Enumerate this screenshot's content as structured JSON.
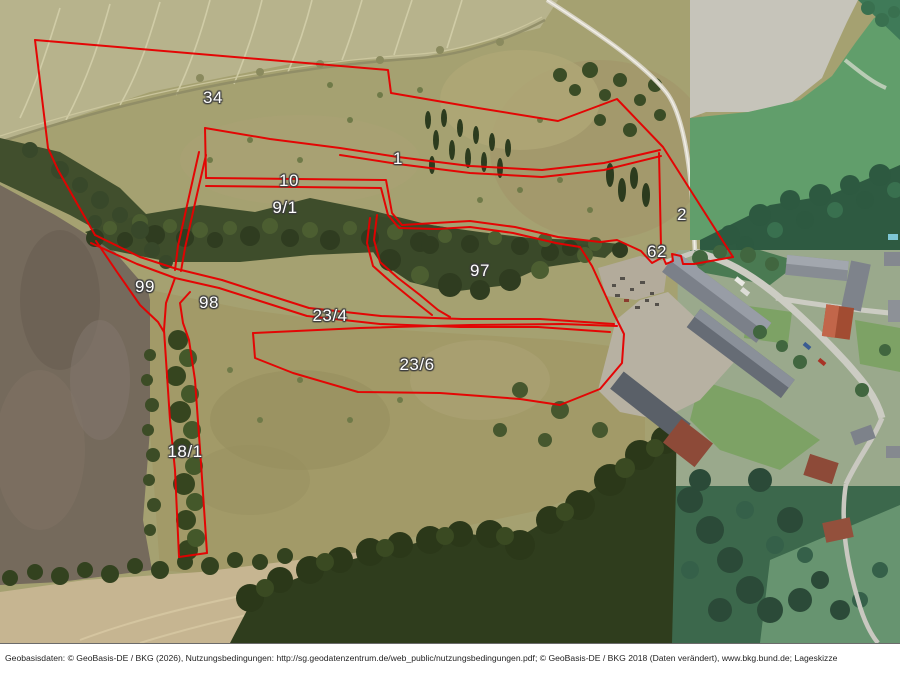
{
  "map": {
    "type_note": "aerial site sketch (Lageskizze) with red parcel boundaries",
    "parcel_labels": [
      {
        "text": "34"
      },
      {
        "text": "1"
      },
      {
        "text": "10"
      },
      {
        "text": "9/1"
      },
      {
        "text": "2"
      },
      {
        "text": "62"
      },
      {
        "text": "97"
      },
      {
        "text": "99"
      },
      {
        "text": "98"
      },
      {
        "text": "23/4"
      },
      {
        "text": "23/6"
      },
      {
        "text": "18/1"
      }
    ]
  },
  "colors": {
    "boundary_red": "#e60000",
    "label_text": "#ffffff",
    "label_halo": "#3f3f3f"
  },
  "footer": {
    "text": "Geobasisdaten: © GeoBasis-DE / BKG (2026), Nutzungsbedingungen: http://sg.geodatenzentrum.de/web_public/nutzungsbedingungen.pdf; © GeoBasis-DE / BKG 2018 (Daten verändert), www.bkg.bund.de; Lageskizze"
  }
}
